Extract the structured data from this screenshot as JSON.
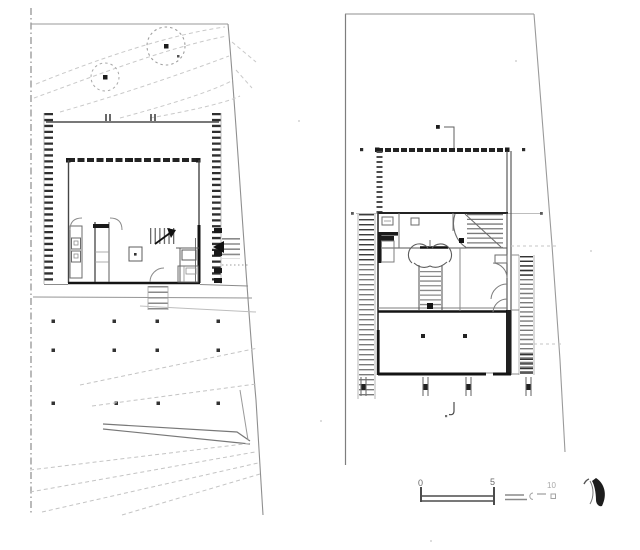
{
  "drawing": {
    "colors": {
      "paper": "#ffffff",
      "ink": "#1c1c1c",
      "wall": "#3a3a3a",
      "mid": "#6f6f6f",
      "light": "#9c9c9c",
      "ghost": "#c7c7c7"
    }
  },
  "scale_bar": {
    "labels": [
      "0",
      "5",
      "10"
    ]
  }
}
